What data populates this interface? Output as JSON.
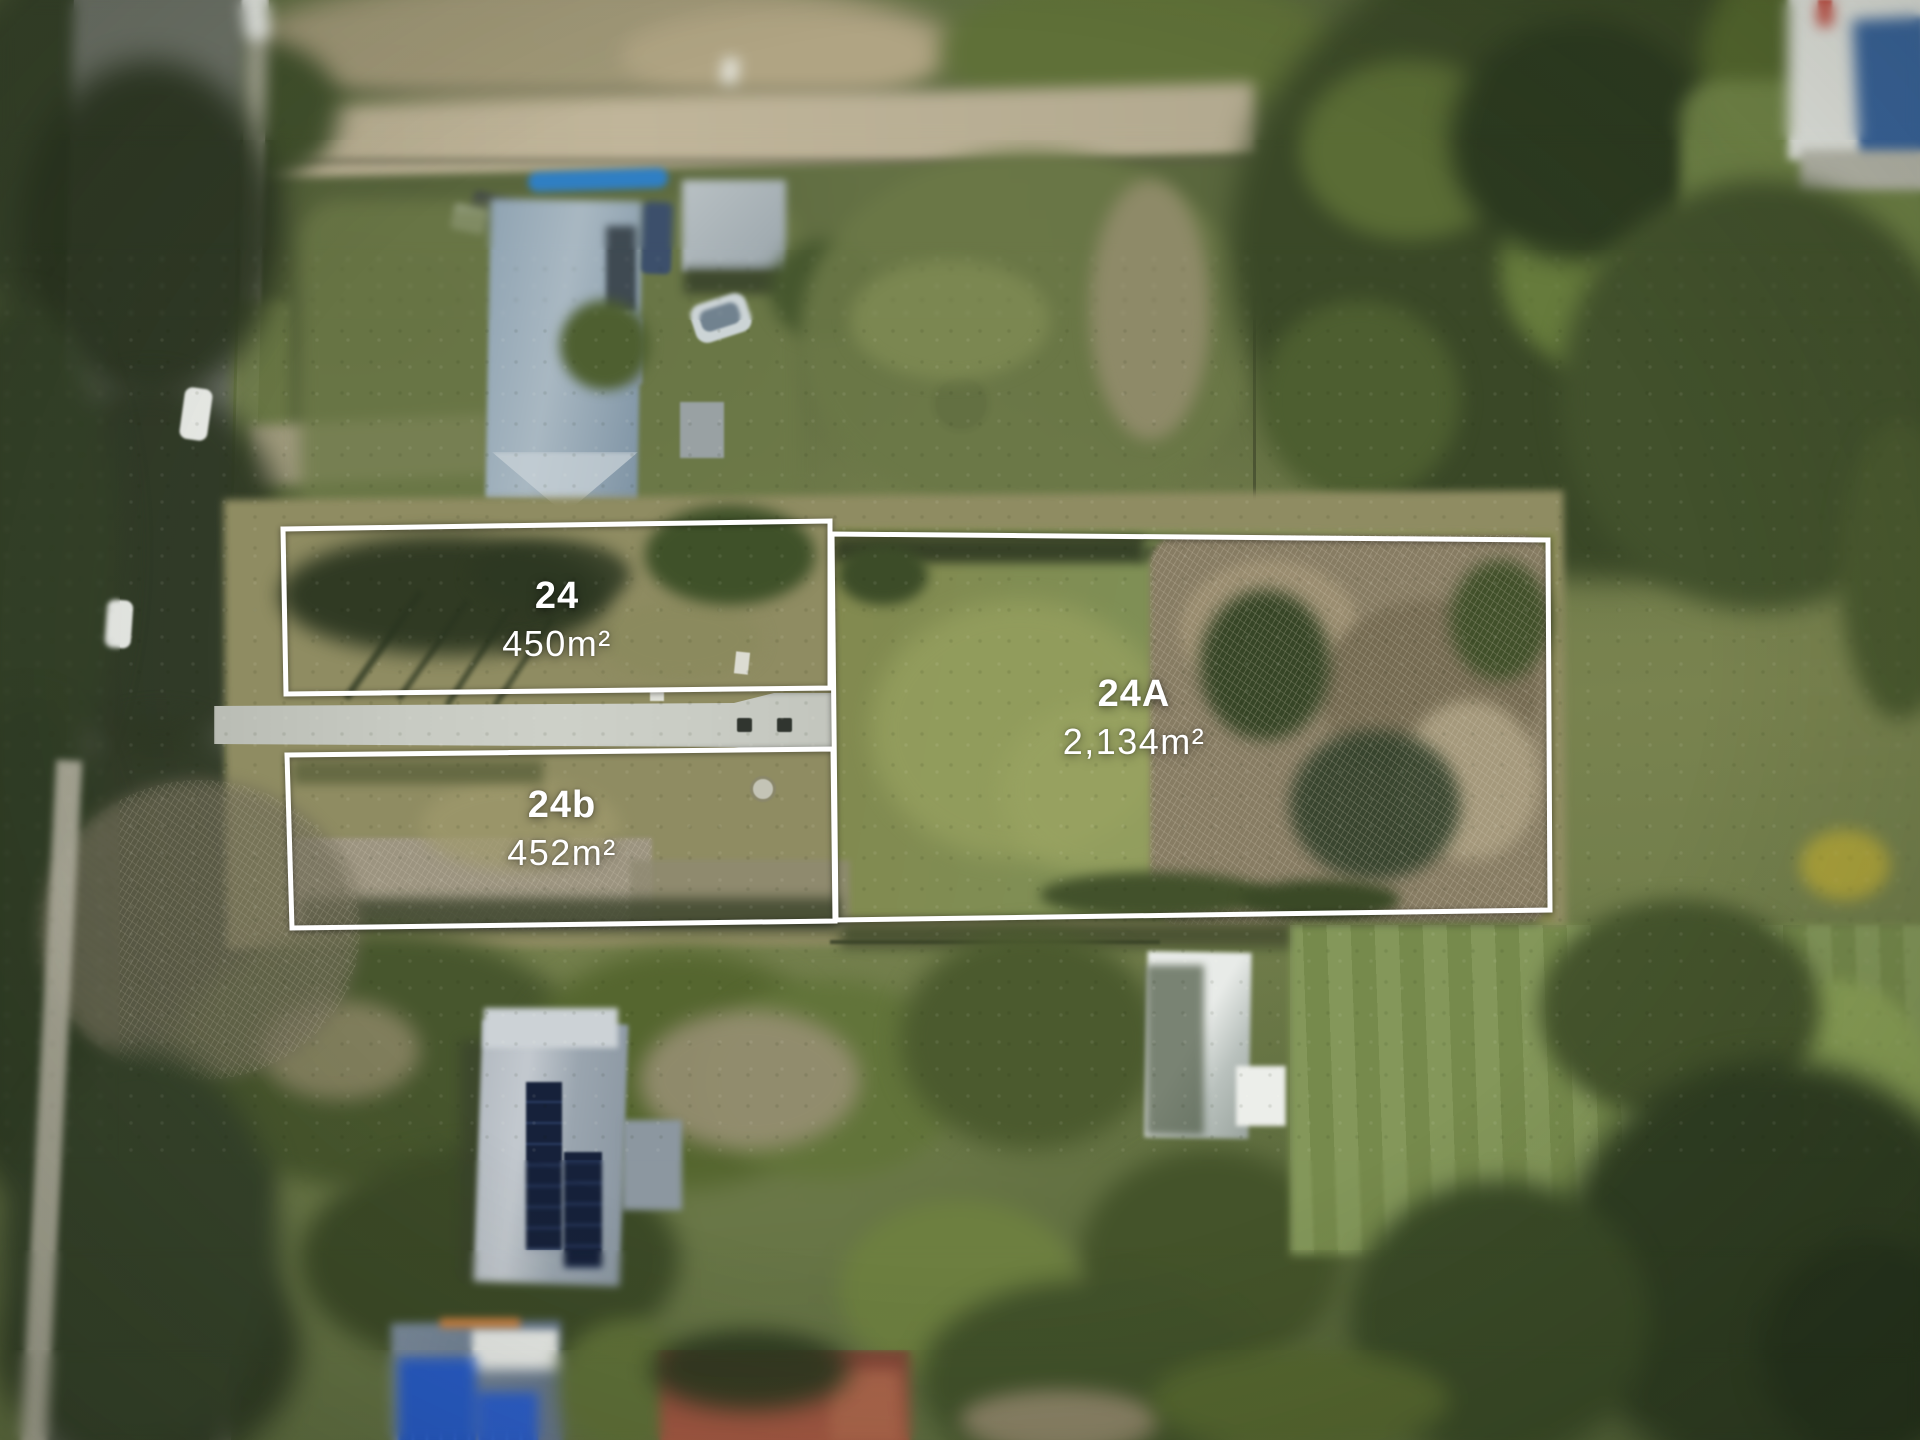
{
  "photo": {
    "type": "aerial-drone-photo",
    "scene": "Aerial view of residential street with three land lots outlined in white, surrounded by houses, trees, lawns, a road and a concrete driveway",
    "boundary_color": "#ffffff",
    "label_text_color": "#ffffff"
  },
  "lots": [
    {
      "id": "24",
      "area": "450m²"
    },
    {
      "id": "24b",
      "area": "452m²"
    },
    {
      "id": "24A",
      "area": "2,134m²"
    }
  ]
}
